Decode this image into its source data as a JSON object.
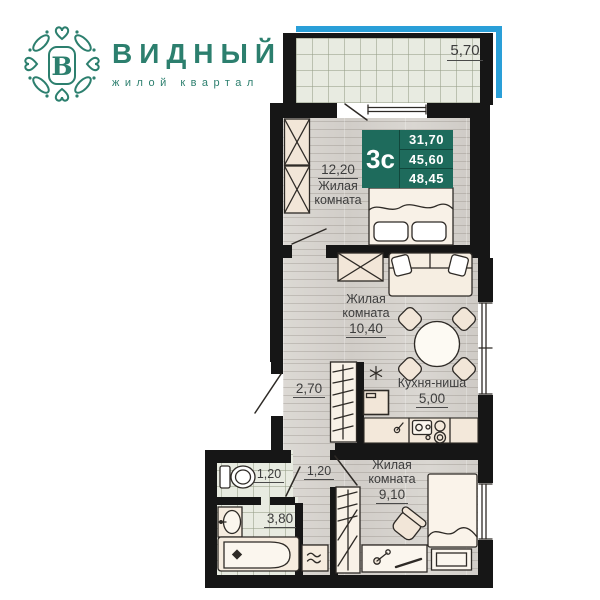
{
  "brand": {
    "name": "ВИДНЫЙ",
    "tagline": "жилой квартал",
    "monogram": "В",
    "color": "#2c7f6e"
  },
  "badge": {
    "type": "3с",
    "area_living": "31,70",
    "area_apartment": "45,60",
    "area_total": "48,45",
    "color": "#1e6b5c"
  },
  "rooms": {
    "balcony": {
      "area": "5,70"
    },
    "room1": {
      "name": "Жилая комната",
      "area": "12,20"
    },
    "room2": {
      "name": "Жилая комната",
      "area": "10,40"
    },
    "kitchen": {
      "name": "Кухня-ниша",
      "area": "5,00"
    },
    "hall": {
      "area": "2,70"
    },
    "wc": {
      "area": "1,20"
    },
    "corridor": {
      "area": "1,20"
    },
    "bathroom": {
      "area": "3,80"
    },
    "room3": {
      "name": "Жилая комната",
      "area": "9,10"
    }
  },
  "colors": {
    "balcony_accent": "#2a9fd8",
    "wall": "#161616",
    "label": "#3d3d3d"
  }
}
